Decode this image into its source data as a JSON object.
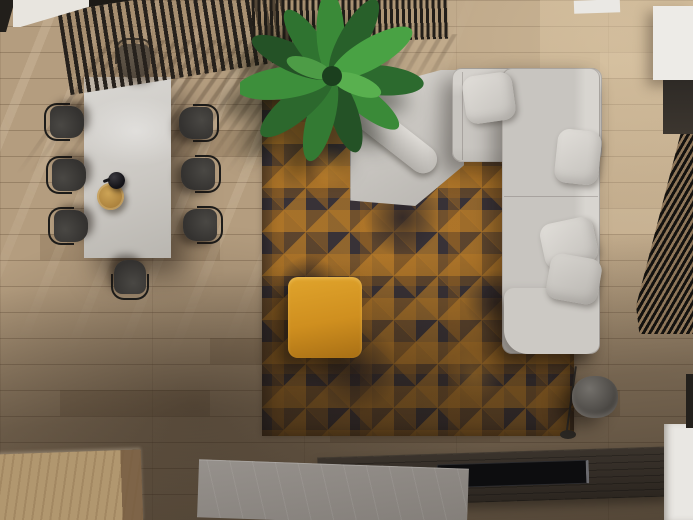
{
  "scene": {
    "label": "Top-down 3D render of a modern living and dining room",
    "view": "bird's-eye",
    "room_zones": [
      "dining area",
      "lounge area",
      "media wall"
    ]
  },
  "palette": {
    "floor": "#b49d7f",
    "rug-base": "#383237",
    "rug-accent": "#c98a2e",
    "sofa-light": "#d5d2cd",
    "pillow": "#e0ddd8",
    "ottoman-hi": "#e0a42c",
    "ottoman-lo": "#a86f15",
    "table-top": "#d2d0cc",
    "chair-dark": "#343230",
    "plant-green": "#2f6b2f",
    "wood-dark": "#332d27",
    "stone": "#908b86",
    "white-surface": "#edebe7",
    "lamp-gray": "#514e4a",
    "wood-block": "#b1976f"
  },
  "objects": {
    "floor": {
      "label": "light oak plank floor with sun streaks"
    },
    "rug": {
      "label": "distressed charcoal rug with gold triangle pattern"
    },
    "sofa": {
      "label": "light gray L-shaped sectional sofa with chaise"
    },
    "pillows": {
      "label": "gray throw pillows",
      "count": 4
    },
    "bolster": {
      "label": "angled bolster cushion on chaise"
    },
    "ottoman": {
      "label": "mustard orange square pouf"
    },
    "table": {
      "label": "white marble dining table"
    },
    "tray": {
      "label": "round wooden serving tray"
    },
    "teapot": {
      "label": "black teapot"
    },
    "chairs": {
      "label": "dark dining chair",
      "count": 8
    },
    "plant": {
      "label": "potted banana-leaf plant"
    },
    "screen_a": {
      "label": "slatted wood divider screen"
    },
    "screen_b": {
      "label": "slatted wood divider screen behind plant"
    },
    "blind": {
      "label": "dark louvered window blind"
    },
    "cabinet": {
      "label": "white cabinet top right"
    },
    "dark_panel": {
      "label": "dark wall panel"
    },
    "wood_bench": {
      "label": "light wood bench block"
    },
    "stone_slab": {
      "label": "concrete platform slab"
    },
    "console": {
      "label": "dark wood media console"
    },
    "tv": {
      "label": "flat black TV panel on console"
    },
    "white_platform": {
      "label": "white step platform bottom right"
    },
    "lamp": {
      "label": "gray cylindrical floor lamp"
    }
  }
}
